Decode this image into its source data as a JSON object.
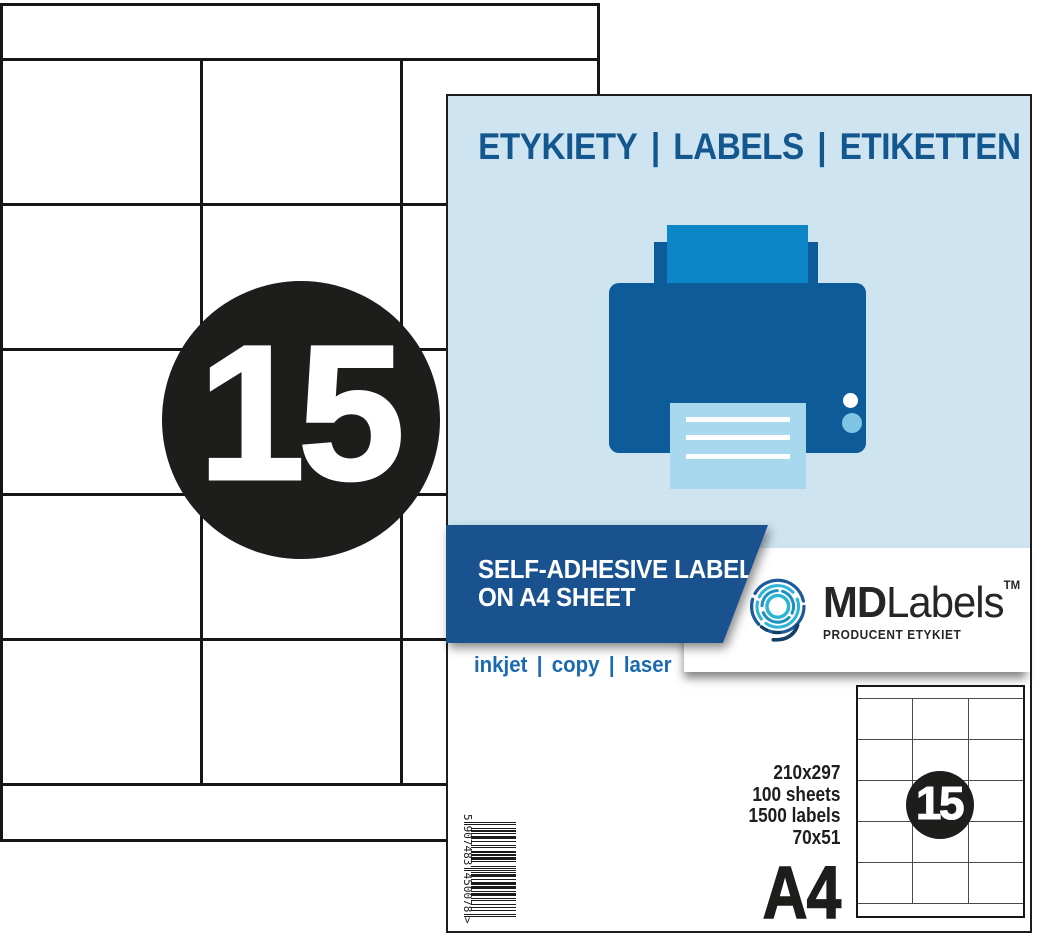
{
  "product": {
    "count": "15",
    "format": "A4",
    "ean": "5907483450078",
    "ean_display": {
      "first": "5",
      "left": "907483",
      "right": "450078",
      "suffix": ">"
    }
  },
  "sheet": {
    "columns": 3,
    "rows": 5
  },
  "card": {
    "header": {
      "items": [
        "ETYKIETY",
        "LABELS",
        "ETIKETTEN"
      ],
      "separator": "|"
    },
    "banner": {
      "line1": "SELF-ADHESIVE LABELS",
      "line2": "ON A4 SHEET"
    },
    "print_methods": {
      "items": [
        "inkjet",
        "copy",
        "laser"
      ],
      "separator": "|"
    },
    "brand": {
      "name_bold": "MD",
      "name_light": "Labels",
      "trademark": "TM",
      "tagline": "PRODUCENT ETYKIET"
    },
    "specs": [
      "210x297",
      "100 sheets",
      "1500 labels",
      "70x51"
    ]
  },
  "colors": {
    "light_blue_bg": "#cee5f1",
    "header_blue": "#14578f",
    "banner_blue": "#1a5290",
    "printer_body_blue": "#0e5b9a",
    "printer_paper_blue": "#0c86c7",
    "printer_output_paper": "#a7d8ed",
    "methods_blue": "#1a6ab2",
    "logo_navy": "#1d5a9b",
    "logo_cyan": "#2fb3d6",
    "ink_black": "#1d1d1b"
  }
}
